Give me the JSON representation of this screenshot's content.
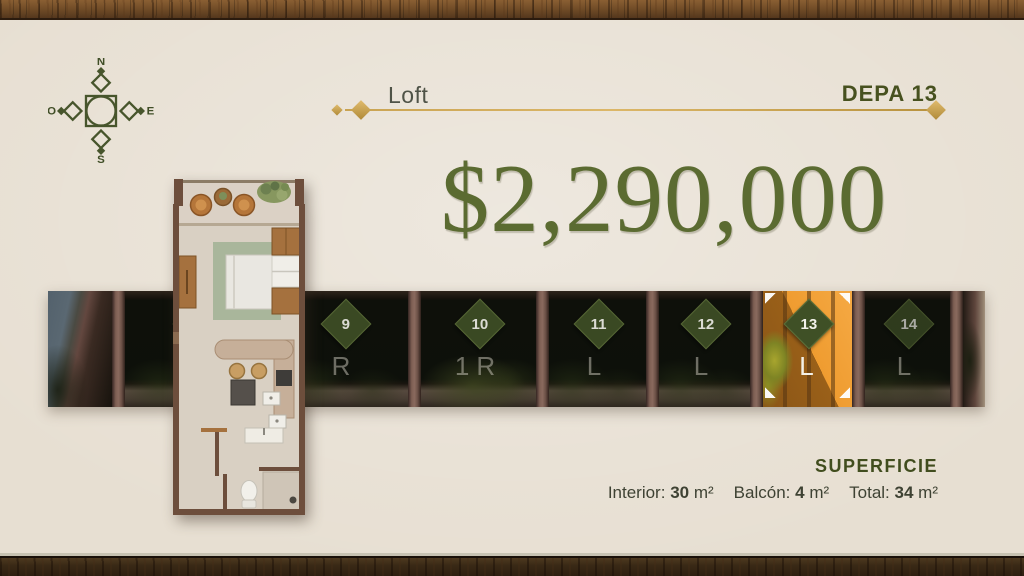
{
  "colors": {
    "background": "#e7dfd2",
    "accent_gold": "#c9a352",
    "olive_text": "#5b6b31",
    "dark_olive": "#47511f",
    "badge_green": "#3f5026",
    "highlight_orange": "#ef9c30",
    "wood_brown": "#6e4a26"
  },
  "compass": {
    "north": "N",
    "east": "E",
    "south": "S",
    "west": "O"
  },
  "header": {
    "section_label": "Loft",
    "unit_name": "DEPA 13"
  },
  "price": {
    "amount": "$2,290,000"
  },
  "units_strip": {
    "units": [
      {
        "number": "8",
        "type": "2R",
        "highlighted": false
      },
      {
        "number": "9",
        "type": "R",
        "highlighted": false
      },
      {
        "number": "10",
        "type": "1R",
        "highlighted": false
      },
      {
        "number": "11",
        "type": "L",
        "highlighted": false
      },
      {
        "number": "12",
        "type": "L",
        "highlighted": false
      },
      {
        "number": "13",
        "type": "L",
        "highlighted": true
      },
      {
        "number": "14",
        "type": "L",
        "highlighted": false
      }
    ]
  },
  "superficie": {
    "title": "SUPERFICIE",
    "measurements": [
      {
        "label": "Interior:",
        "value": "30",
        "unit": "m²"
      },
      {
        "label": "Balcón:",
        "value": "4",
        "unit": "m²"
      },
      {
        "label": "Total:",
        "value": "34",
        "unit": "m²"
      }
    ]
  }
}
